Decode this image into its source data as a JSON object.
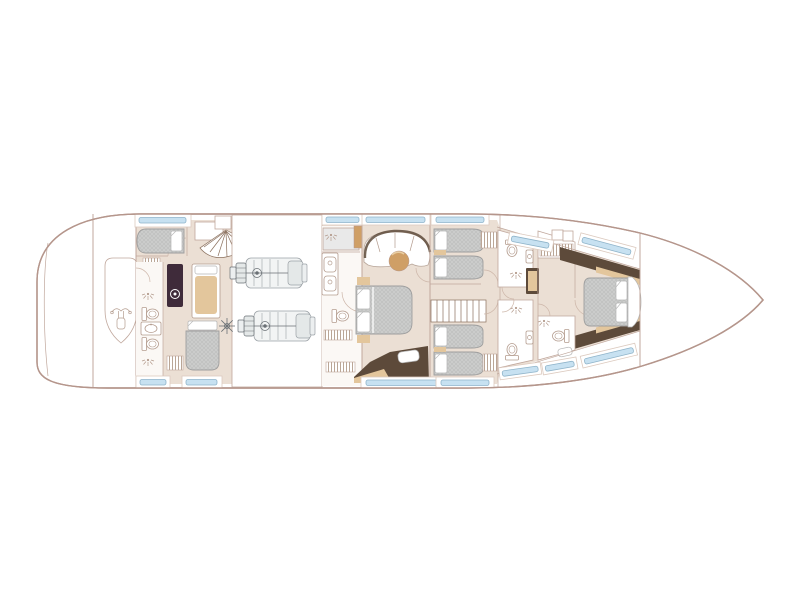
{
  "document": {
    "kind": "yacht-lower-deck-floor-plan",
    "orientation": "bow-right-stern-left",
    "visible_text": []
  },
  "colors": {
    "background": "#ffffff",
    "hull-line": "#b5968c",
    "wall": "#c0a79c",
    "floor": "#ebdfd4",
    "shower-gray": "#e9e9e9",
    "bed-fill": "#cbcccb",
    "bed-hatch": "#b9bab9",
    "bed-edge": "#9e9e9e",
    "pillow-edge": "#b5b5b5",
    "window-fill": "#c7e1f1",
    "window-edge": "#8fb4ca",
    "window-frame-edge": "#dccabf",
    "tan": "#cf9f66",
    "tan-light": "#e3c69c",
    "dark-wood": "#5d4a3a",
    "washer": "#3f2b3a",
    "fixture": "#b49c8e",
    "door-arc": "#cdb6a9",
    "stair-line": "#8a6f5c",
    "engine-line": "#9ba1a6",
    "engine-fill": "#f2f4f4",
    "engine-dark": "#6a7075",
    "hatch-line": "#a98f7b"
  },
  "plan": {
    "areas": [
      "swim-platform-and-tender-garage",
      "crew-quarters-with-bathroom-and-laundry",
      "engine-room-with-two-engines",
      "master-stateroom-with-ensuite",
      "twin-guest-cabins-with-staircase",
      "guest-bathrooms",
      "vip-forward-stateroom-with-ensuite-and-wardrobe",
      "bow-locker"
    ],
    "icon_names": [
      "tender-outline",
      "jetski-icon",
      "shower-icon",
      "toilet-icon",
      "sink-icon",
      "washing-machine",
      "round-table-icon",
      "staircase-fan-icon",
      "staircase-straight-icon",
      "wardrobe-rail-hatch",
      "hull-window-strip",
      "engine-plan-icon",
      "door-swing-arc"
    ],
    "window_strip_count": 13,
    "bed_count": 9
  }
}
